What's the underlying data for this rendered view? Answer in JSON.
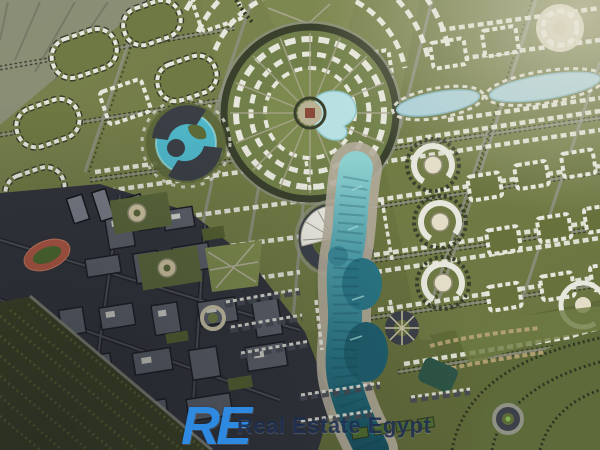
{
  "watermark": {
    "logo_text": "RE",
    "brand": "Real Estate Egypt"
  },
  "colors": {
    "logo_blue": "#2f8de8",
    "watermark_navy": "#1a294c",
    "lawn_green": "#6b7540",
    "dark_trees": "#2f3523",
    "white_buildings": "#e6e6dc",
    "river_teal": "#2a7584",
    "plaza_pond_cyan": "#b8e0e2",
    "swirl_lake_turquoise": "#4fb7c9",
    "downtown_gray": "#31343b",
    "stadium_track_red": "#b25843",
    "promenade_tan": "#b3ab9a"
  }
}
